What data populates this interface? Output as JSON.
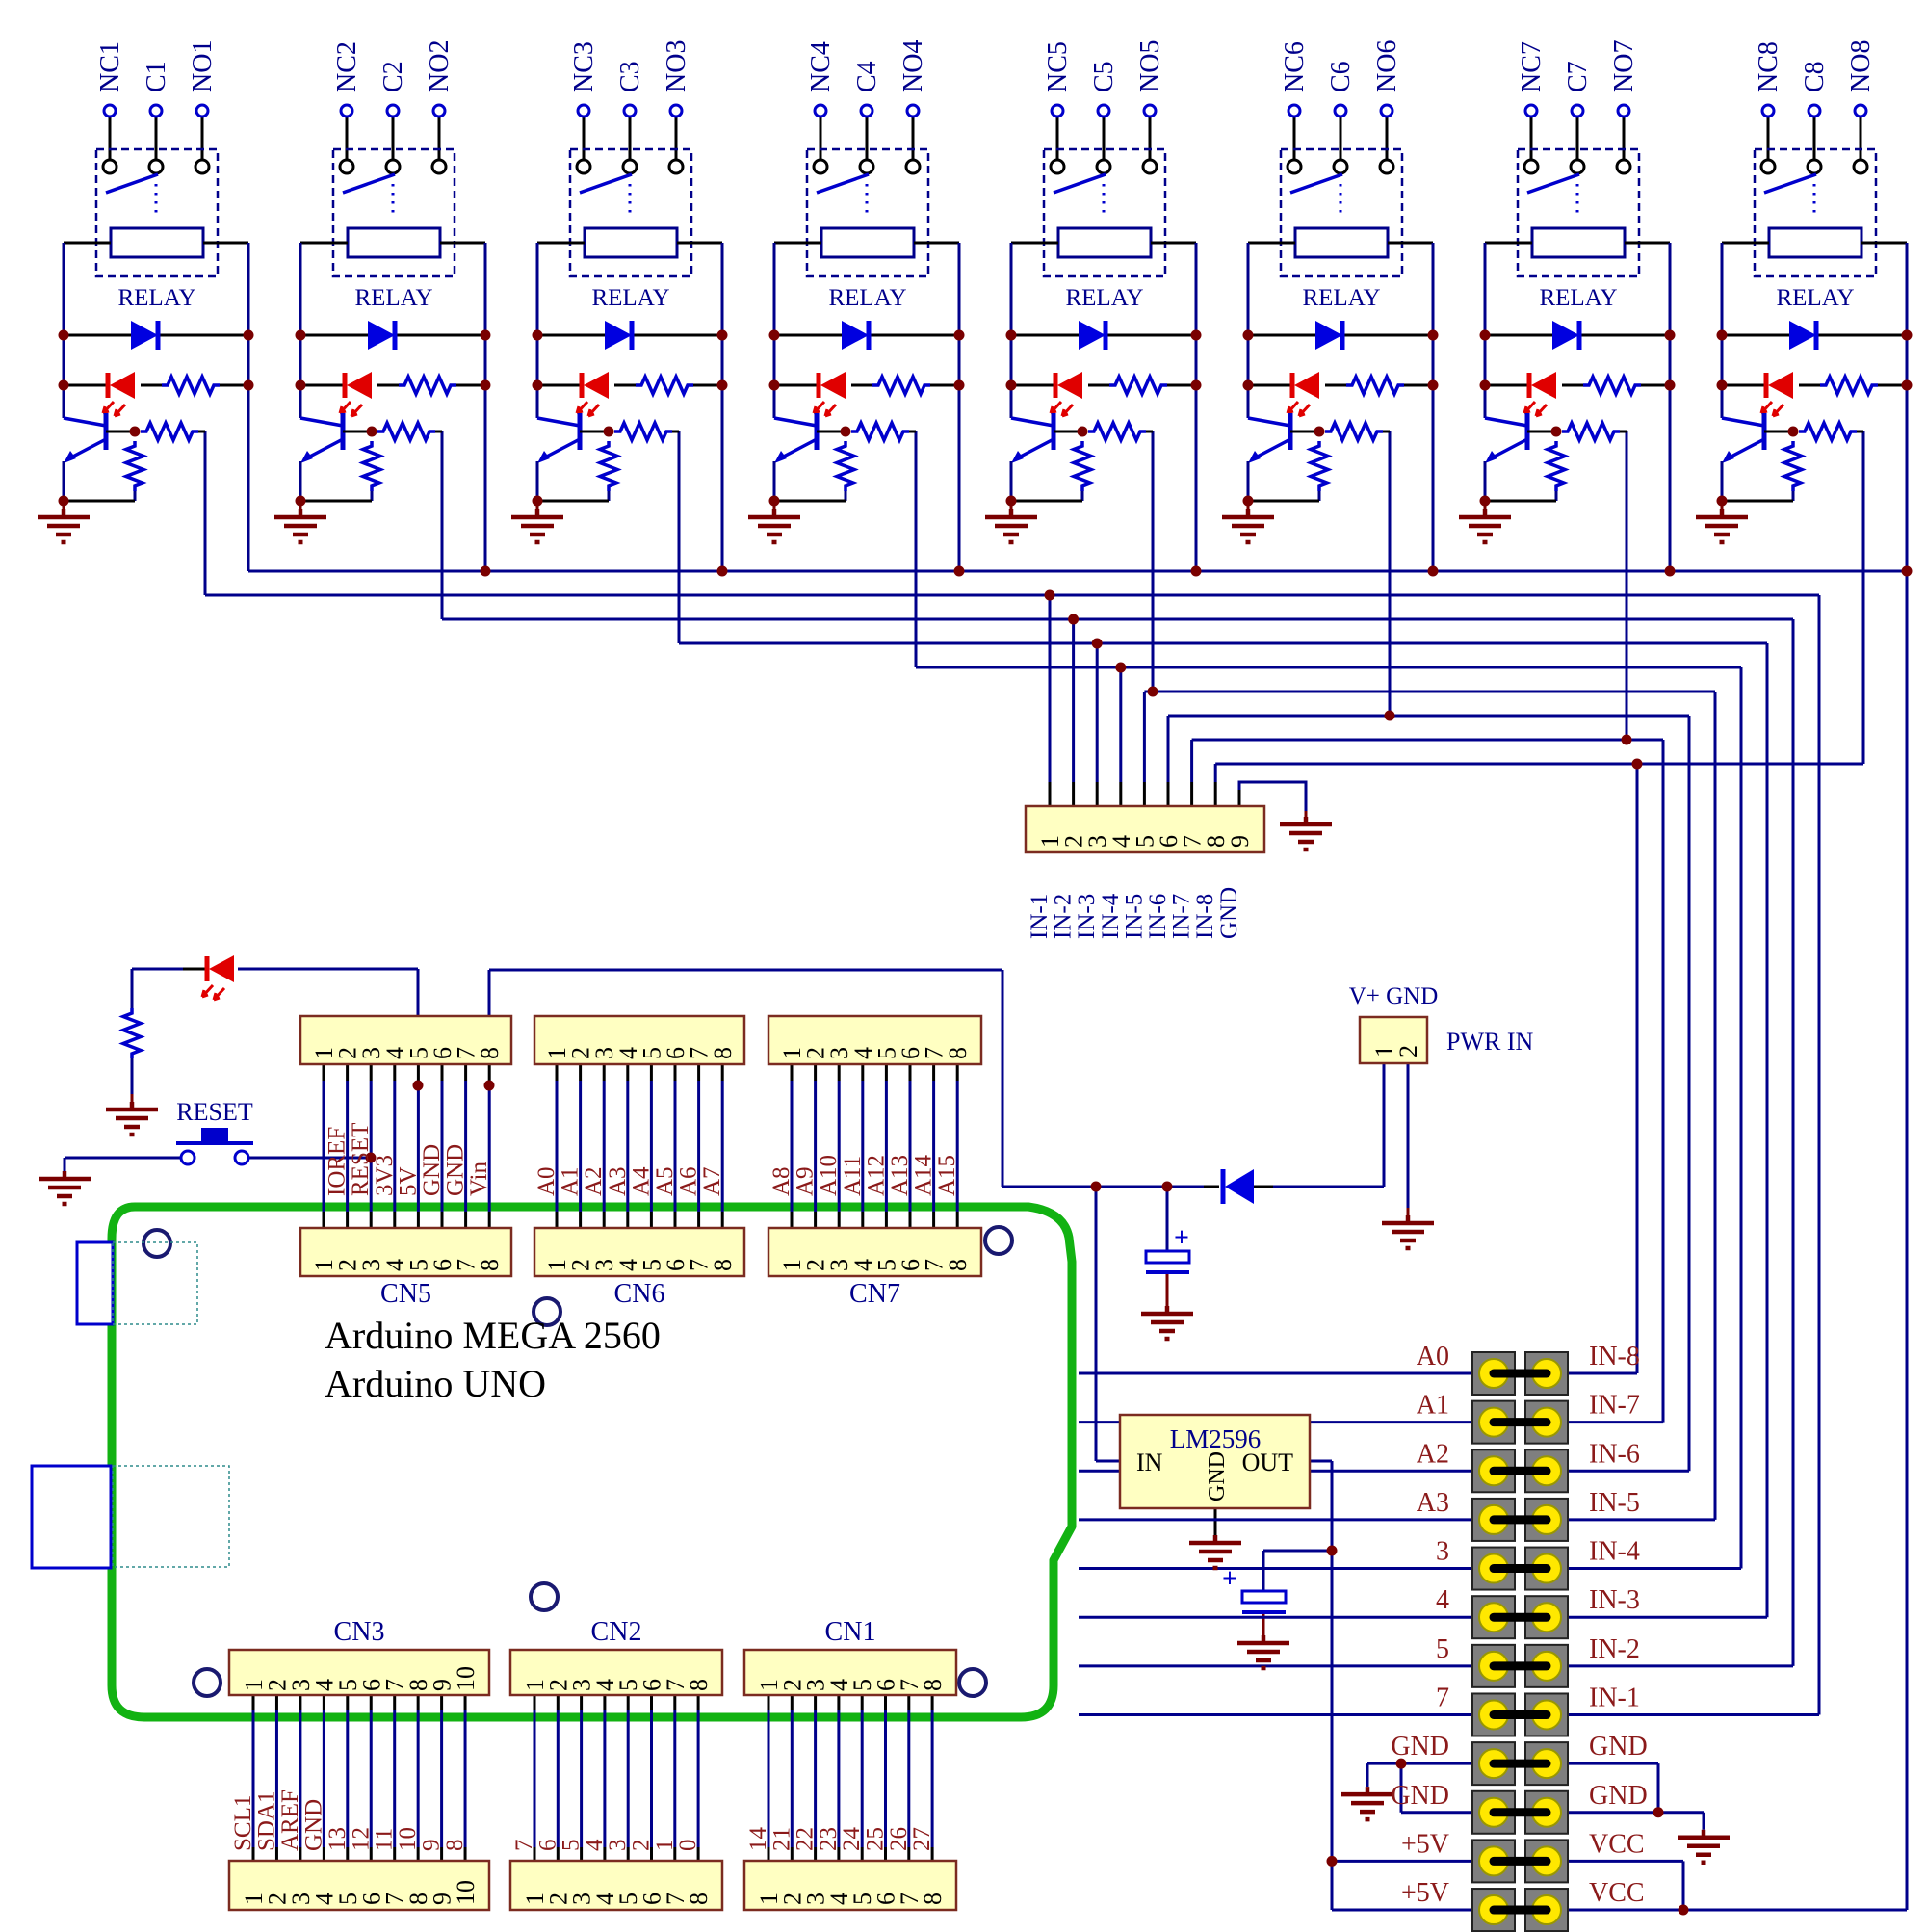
{
  "colors": {
    "wire": "#00008B",
    "component": "#0000CC",
    "diode_fill": "#0000E0",
    "led": "#E00000",
    "junction": "#7A0000",
    "ground": "#7A0000",
    "connector_fill": "#FFFFC2",
    "connector_border": "#7B2B20",
    "signal_text": "#8B1A1A",
    "label_text": "#00008B",
    "board_outline": "#12B212",
    "pad_yellow": "#FFE800",
    "pad_gray": "#7F7F7F",
    "hole_ring": "#191970"
  },
  "relays": [
    {
      "nc": "NC1",
      "c": "C1",
      "no": "NO1",
      "label": "RELAY"
    },
    {
      "nc": "NC2",
      "c": "C2",
      "no": "NO2",
      "label": "RELAY"
    },
    {
      "nc": "NC3",
      "c": "C3",
      "no": "NO3",
      "label": "RELAY"
    },
    {
      "nc": "NC4",
      "c": "C4",
      "no": "NO4",
      "label": "RELAY"
    },
    {
      "nc": "NC5",
      "c": "C5",
      "no": "NO5",
      "label": "RELAY"
    },
    {
      "nc": "NC6",
      "c": "C6",
      "no": "NO6",
      "label": "RELAY"
    },
    {
      "nc": "NC7",
      "c": "C7",
      "no": "NO7",
      "label": "RELAY"
    },
    {
      "nc": "NC8",
      "c": "C8",
      "no": "NO8",
      "label": "RELAY"
    }
  ],
  "in_header": {
    "pins": [
      "1",
      "2",
      "3",
      "4",
      "5",
      "6",
      "7",
      "8",
      "9"
    ],
    "signals": [
      "IN-1",
      "IN-2",
      "IN-3",
      "IN-4",
      "IN-5",
      "IN-6",
      "IN-7",
      "IN-8",
      "GND"
    ]
  },
  "cn5": {
    "label": "CN5",
    "pins": [
      "1",
      "2",
      "3",
      "4",
      "5",
      "6",
      "7",
      "8"
    ],
    "signals": [
      "",
      "IOREF",
      "RESET",
      "3V3",
      "5V",
      "GND",
      "GND",
      "Vin"
    ]
  },
  "cn6": {
    "label": "CN6",
    "pins": [
      "1",
      "2",
      "3",
      "4",
      "5",
      "6",
      "7",
      "8"
    ],
    "signals": [
      "A0",
      "A1",
      "A2",
      "A3",
      "A4",
      "A5",
      "A6",
      "A7"
    ]
  },
  "cn7": {
    "label": "CN7",
    "pins": [
      "1",
      "2",
      "3",
      "4",
      "5",
      "6",
      "7",
      "8"
    ],
    "signals": [
      "A8",
      "A9",
      "A10",
      "A11",
      "A12",
      "A13",
      "A14",
      "A15"
    ]
  },
  "cn3": {
    "label": "CN3",
    "pins": [
      "1",
      "2",
      "3",
      "4",
      "5",
      "6",
      "7",
      "8",
      "9",
      "10"
    ],
    "signals": [
      "SCL1",
      "SDA1",
      "AREF",
      "GND",
      "13",
      "12",
      "11",
      "10",
      "9",
      "8"
    ]
  },
  "cn2": {
    "label": "CN2",
    "pins": [
      "1",
      "2",
      "3",
      "4",
      "5",
      "6",
      "7",
      "8"
    ],
    "signals": [
      "7",
      "6",
      "5",
      "4",
      "3",
      "2",
      "1",
      "0"
    ]
  },
  "cn1": {
    "label": "CN1",
    "pins": [
      "1",
      "2",
      "3",
      "4",
      "5",
      "6",
      "7",
      "8"
    ],
    "signals": [
      "14",
      "21",
      "22",
      "23",
      "24",
      "25",
      "26",
      "27"
    ]
  },
  "pwr_in": {
    "label": "PWR IN",
    "pins_label": "V+ GND",
    "pins": [
      "1",
      "2"
    ]
  },
  "regulator": {
    "title": "LM2596",
    "pin_in": "IN",
    "pin_gnd": "GND",
    "pin_out": "OUT"
  },
  "board": {
    "line1": "Arduino MEGA 2560",
    "line2": "Arduino UNO"
  },
  "reset_button": {
    "label": "RESET"
  },
  "capacitors": {
    "plus": "+"
  },
  "jumper_block": {
    "rows": [
      {
        "left": "A0",
        "right": "IN-8"
      },
      {
        "left": "A1",
        "right": "IN-7"
      },
      {
        "left": "A2",
        "right": "IN-6"
      },
      {
        "left": "A3",
        "right": "IN-5"
      },
      {
        "left": "3",
        "right": "IN-4"
      },
      {
        "left": "4",
        "right": "IN-3"
      },
      {
        "left": "5",
        "right": "IN-2"
      },
      {
        "left": "7",
        "right": "IN-1"
      },
      {
        "left": "GND",
        "right": "GND"
      },
      {
        "left": "GND",
        "right": "GND"
      },
      {
        "left": "+5V",
        "right": "VCC"
      },
      {
        "left": "+5V",
        "right": "VCC"
      }
    ]
  }
}
